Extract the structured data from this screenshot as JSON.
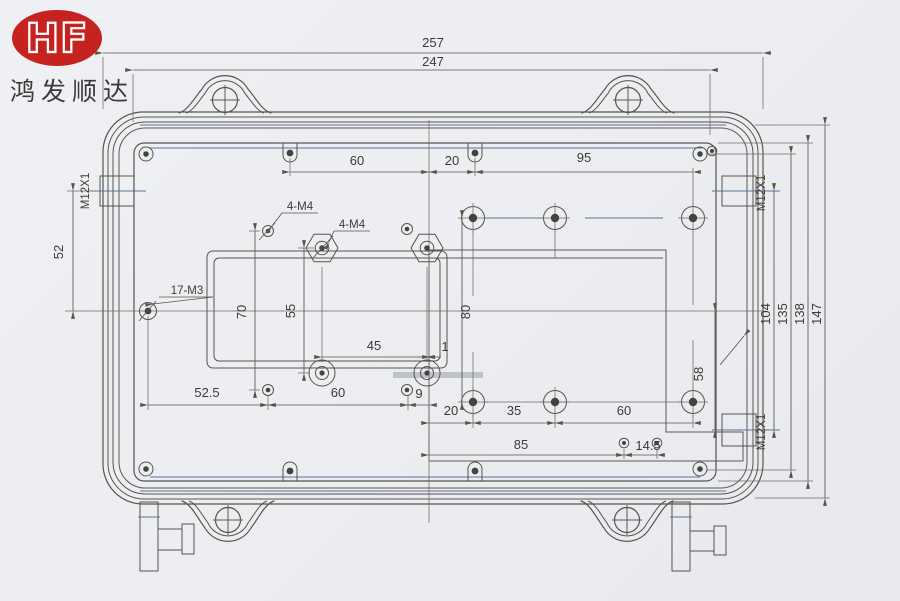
{
  "brand": {
    "logo_text": "HF",
    "trademark": "™",
    "company_name": "鸿发顺达",
    "logo_bg_color": "#c62320",
    "logo_text_color": "#ffffff"
  },
  "drawing": {
    "type": "enclosure-internal-dimension-drawing",
    "ink_color": "#57544b",
    "accent_blue": "#5f7196",
    "paper_color": "#ebedf1",
    "labels": {
      "gland_thread": "M12X1",
      "m3_holes": "17-M3",
      "m4_holes": "4-M4"
    },
    "dimensions": {
      "overall_width": "257",
      "lid_width": "247",
      "top_span_60": "60",
      "top_span_20": "20",
      "top_span_95": "95",
      "gland_offset_52": "52",
      "height_70": "70",
      "height_55": "55",
      "height_80": "80",
      "width_45": "45",
      "offset_1": "1",
      "bottom_52_5": "52.5",
      "bottom_60": "60",
      "bottom_9": "9",
      "lower_20": "20",
      "lower_35": "35",
      "lower_60": "60",
      "step_85": "85",
      "step_14_5": "14.5",
      "right_58": "58",
      "right_104": "104",
      "right_135": "135",
      "right_138": "138",
      "right_147": "147"
    }
  }
}
